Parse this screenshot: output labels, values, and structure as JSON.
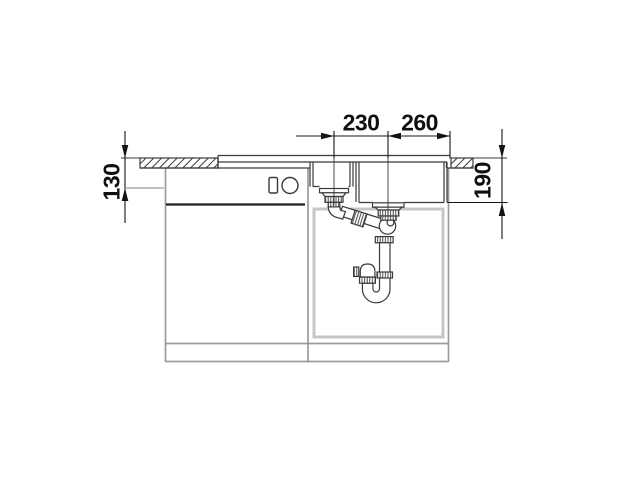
{
  "diagram": {
    "type": "technical-drawing",
    "dimension_labels": {
      "top_left": "230",
      "top_right": "260",
      "left_side": "130",
      "right_side": "190"
    },
    "colors": {
      "background": "#ffffff",
      "line": "#3a3a3a",
      "cabinet": "#9c9c9c",
      "door_outline": "#c6c6c6",
      "dimension": "#141414"
    }
  }
}
